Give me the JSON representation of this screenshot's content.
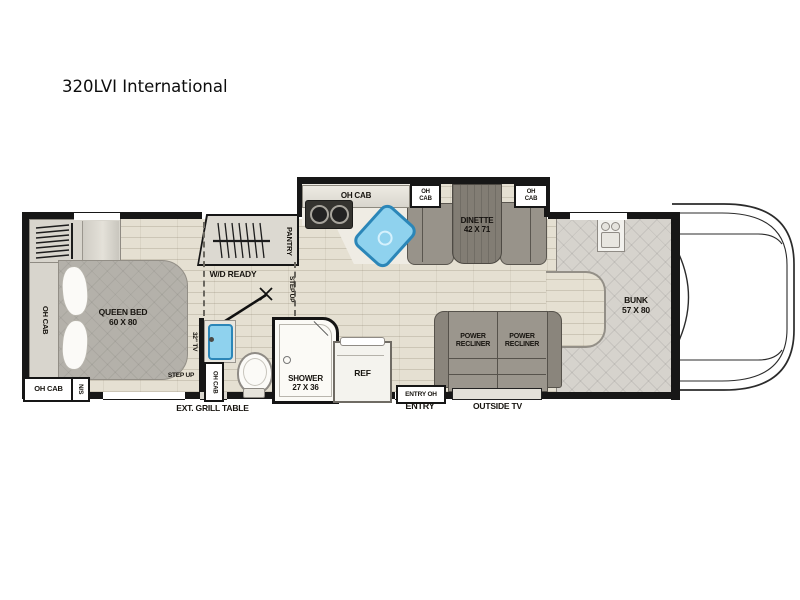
{
  "title": "320LVI International",
  "colors": {
    "wall": "#171717",
    "floor": "#e5e0d2",
    "sink_blue": "#8fd2ee",
    "furniture_gray": "#9b968d",
    "mattress_gray": "#b4b1aa",
    "bunk_quilt": "#d6d3cd",
    "table_wood": "#827d74"
  },
  "bedroom": {
    "oh_cab_side": "OH CAB",
    "bed_name": "QUEEN BED",
    "bed_dims": "60 X 80",
    "oh_cab_front": "OH CAB",
    "nightstand": "N/S",
    "tv_label": "32\" TV",
    "step_up": "STEP UP"
  },
  "utility": {
    "pantry": "PANTRY",
    "wd_ready": "W/D READY",
    "step_up": "STEP UP"
  },
  "bath": {
    "oh_cab": "OH CAB",
    "shower_name": "SHOWER",
    "shower_dims": "27 X 36"
  },
  "kitchen": {
    "oh_cab": "OH CAB",
    "ref": "REF"
  },
  "dinette": {
    "oh_cab_left": "OH CAB",
    "oh_cab_right": "OH CAB",
    "name": "DINETTE",
    "dims": "42 X 71"
  },
  "living": {
    "recliner_left": "POWER RECLINER",
    "recliner_right": "POWER RECLINER",
    "entry_oh": "ENTRY OH",
    "entry": "ENTRY",
    "outside_tv": "OUTSIDE TV",
    "ext_grill_table": "EXT. GRILL TABLE"
  },
  "bunk": {
    "name": "BUNK",
    "dims": "57 X 80"
  }
}
